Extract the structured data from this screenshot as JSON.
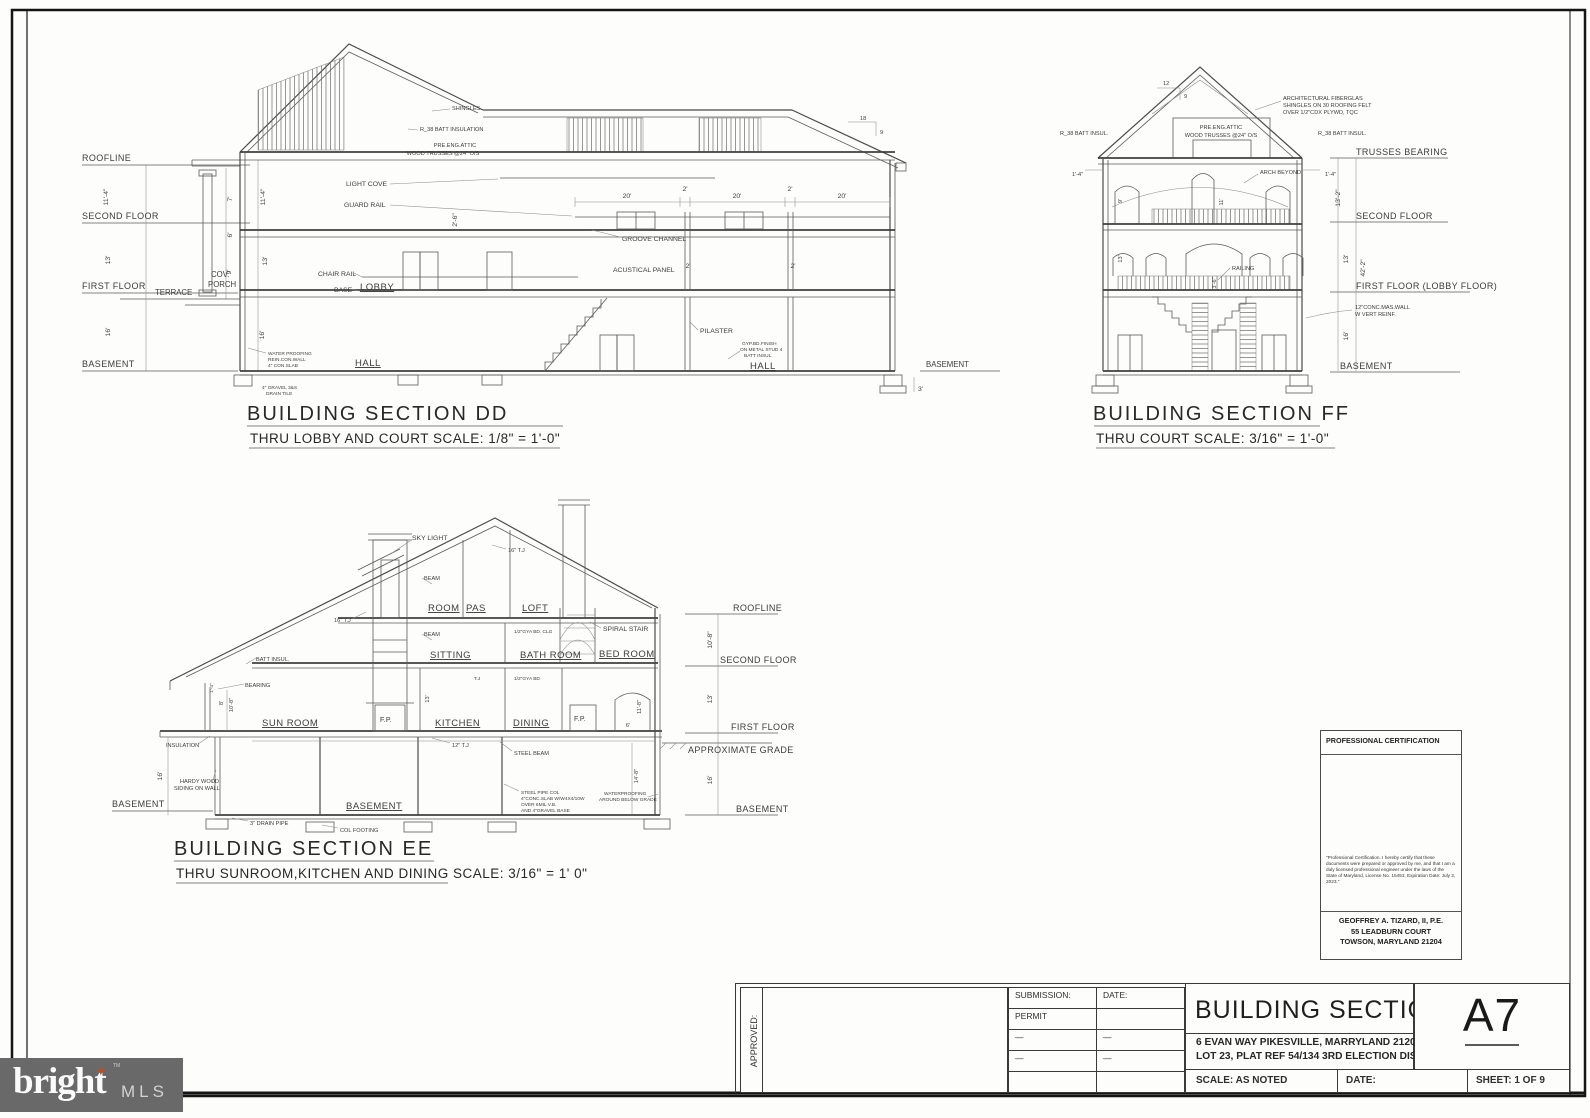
{
  "logo": {
    "brand": "bright",
    "tm": "TM",
    "mls": "MLS"
  },
  "cert": {
    "title": "PROFESSIONAL CERTIFICATION",
    "body": "\"Professional Certification.  I hereby certify that these documents were prepared or approved by me, and that I am a duly licensed professional engineer under the laws of the State of Maryland, License No. 15453, Expiration Date: July 2, 2023.\"",
    "name": "GEOFFREY A. TIZARD, II, P.E.",
    "addr1": "55 LEADBURN COURT",
    "addr2": "TOWSON, MARYLAND 21204"
  },
  "titleblock": {
    "approved": "APPROVED:",
    "submission": "SUBMISSION:",
    "date": "DATE:",
    "permit": "PERMIT",
    "dash": "—",
    "title": "BUILDING SECTION",
    "addr1": "6 EVAN WAY PIKESVILLE, MARRYLAND 21208",
    "addr2": "LOT 23, PLAT REF 54/134 3RD ELECTION DISTRICT",
    "scale": "SCALE: AS NOTED",
    "date2": "DATE:",
    "sheet": "SHEET: 1 OF 9",
    "number": "A7"
  },
  "dd": {
    "title": "BUILDING SECTION  DD",
    "subtitle": "THRU LOBBY AND COURT   SCALE: 1/8\" = 1'-0\"",
    "levels": {
      "roofline": "ROOFLINE",
      "second": "SECOND FLOOR",
      "first": "FIRST FLOOR",
      "terrace": "TERRACE",
      "basement": "BASEMENT",
      "basement_r": "BASEMENT"
    },
    "rooms": {
      "lobby": "LOBBY",
      "hall1": "HALL",
      "hall2": "HALL"
    },
    "ann": {
      "shingles": "SHINGLES",
      "batt": "R_38 BATT INSULATION",
      "attic1": "PRE.ENG.ATTIC",
      "attic2": "WOOD TRUSSES @24\" O/S",
      "lightcove": "LIGHT COVE",
      "guardrail": "GUARD RAIL",
      "groove": "GROOVE CHANNEL",
      "acoustic": "ACUSTICAL PANEL",
      "chairrail": "CHAIR RAIL",
      "base": "BASE",
      "pilaster": "PILASTER",
      "gyp1": "GYP.BD.FINISH",
      "gyp2": "ON METAL STUD 4",
      "gyp3": "BATT INSUL.",
      "cov": "COV.",
      "porch": "PORCH",
      "wp1": "WATER PROOFING",
      "wp2": "REIN.CON.WALL",
      "wp3": "4\" CON.SLAB",
      "gravel1": "4\" GRAVEL 3&S",
      "gravel2": "DRAIN TILE"
    },
    "dims": {
      "h114": "11'-4\"",
      "h13": "13'",
      "h16": "16'",
      "h7": "7'",
      "h6": "6'",
      "h9": "9'",
      "h26": "2'-6\"",
      "w20": "20'",
      "w2": "2'",
      "w3": "3'",
      "s18": "18",
      "s9": "9"
    }
  },
  "ff": {
    "title": "BUILDING SECTION FF",
    "subtitle": "THRU COURT   SCALE: 3/16\" = 1'-0\"",
    "levels": {
      "trusses": "TRUSSES BEARING",
      "second": "SECOND FLOOR",
      "first": "FIRST FLOOR (LOBBY FLOOR)",
      "basement": "BASEMENT"
    },
    "ann": {
      "shing1": "ARCHITECTURAL FIBERGLAS",
      "shing2": "SHINGLES ON 30 ROOFING FELT",
      "shing3": "OVER 1/2\"CDX PLYWD, TQC",
      "attic1": "PRE.ENG.ATTIC",
      "attic2": "WOOD TRUSSES @24\" O/S",
      "battl": "R_38 BATT INSUL.",
      "battr": "R_38 BATT INSUL.",
      "arch": "ARCH BEYOND",
      "railing": "RAILING",
      "wall1": "12\"CONC.MAS.WALL",
      "wall2": "W VERT REINF."
    },
    "dims": {
      "h14": "1'-4\"",
      "h132": "13'-2\"",
      "h13": "13'",
      "h422": "42'-2\"",
      "h16": "16'",
      "h9": "9'",
      "h11": "11'",
      "h36": "3'-6\"",
      "s12": "12",
      "s9": "9"
    }
  },
  "ee": {
    "title": "BUILDING SECTION EE",
    "subtitle": "THRU SUNROOM,KITCHEN AND DINING   SCALE: 3/16\" = 1'  0\"",
    "levels": {
      "roofline": "ROOFLINE",
      "second": "SECOND FLOOR",
      "first": "FIRST FLOOR",
      "grade": "APPROXIMATE GRADE",
      "basement": "BASEMENT",
      "basement_l": "BASEMENT"
    },
    "rooms": {
      "room": "ROOM",
      "pas": "PAS",
      "loft": "LOFT",
      "sitting": "SITTING",
      "bath": "BATH ROOM",
      "bed": "BED ROOM",
      "sun": "SUN ROOM",
      "kitchen": "KITCHEN",
      "dining": "DINING",
      "fp": "F.P.",
      "basement": "BASEMENT"
    },
    "ann": {
      "skylight": "SKY LIGHT",
      "tj16": "16\" T.J",
      "beam": "BEAM",
      "spiral": "SPIRAL STAIR",
      "gyb1": "1/2\"GYA BD. CLG",
      "tj": "T.J",
      "gyb2": "1/2\"GYA BD",
      "batt": "BATT INSUL.",
      "bearing": "BEARING",
      "insul": "INSULATION",
      "hardy1": "HARDY WOOD",
      "hardy2": "SIDING ON WALL",
      "drain": "3\" DRAIN PIPE",
      "colfoot": "COL FOOTING",
      "tj12": "12\" T.J",
      "steel": "STEEL BEAM",
      "pipe1": "STEEL PIPE COL",
      "pipe2": "4\"CONC.SLAB W/W4X4/10W",
      "pipe3": "OVER 6MIL V.B.",
      "pipe4": "AND 4\"GRAVEL BASE",
      "wp1": "WATERPROOFING",
      "wp2": "AROUND BELOW GRADE"
    },
    "dims": {
      "h108": "10'-8\"",
      "h13": "13'",
      "h16": "16'",
      "h8": "8'",
      "h14": "1'-4\"",
      "h148": "14'-8\"",
      "h118": "11'-8\"",
      "w6": "6'"
    }
  }
}
